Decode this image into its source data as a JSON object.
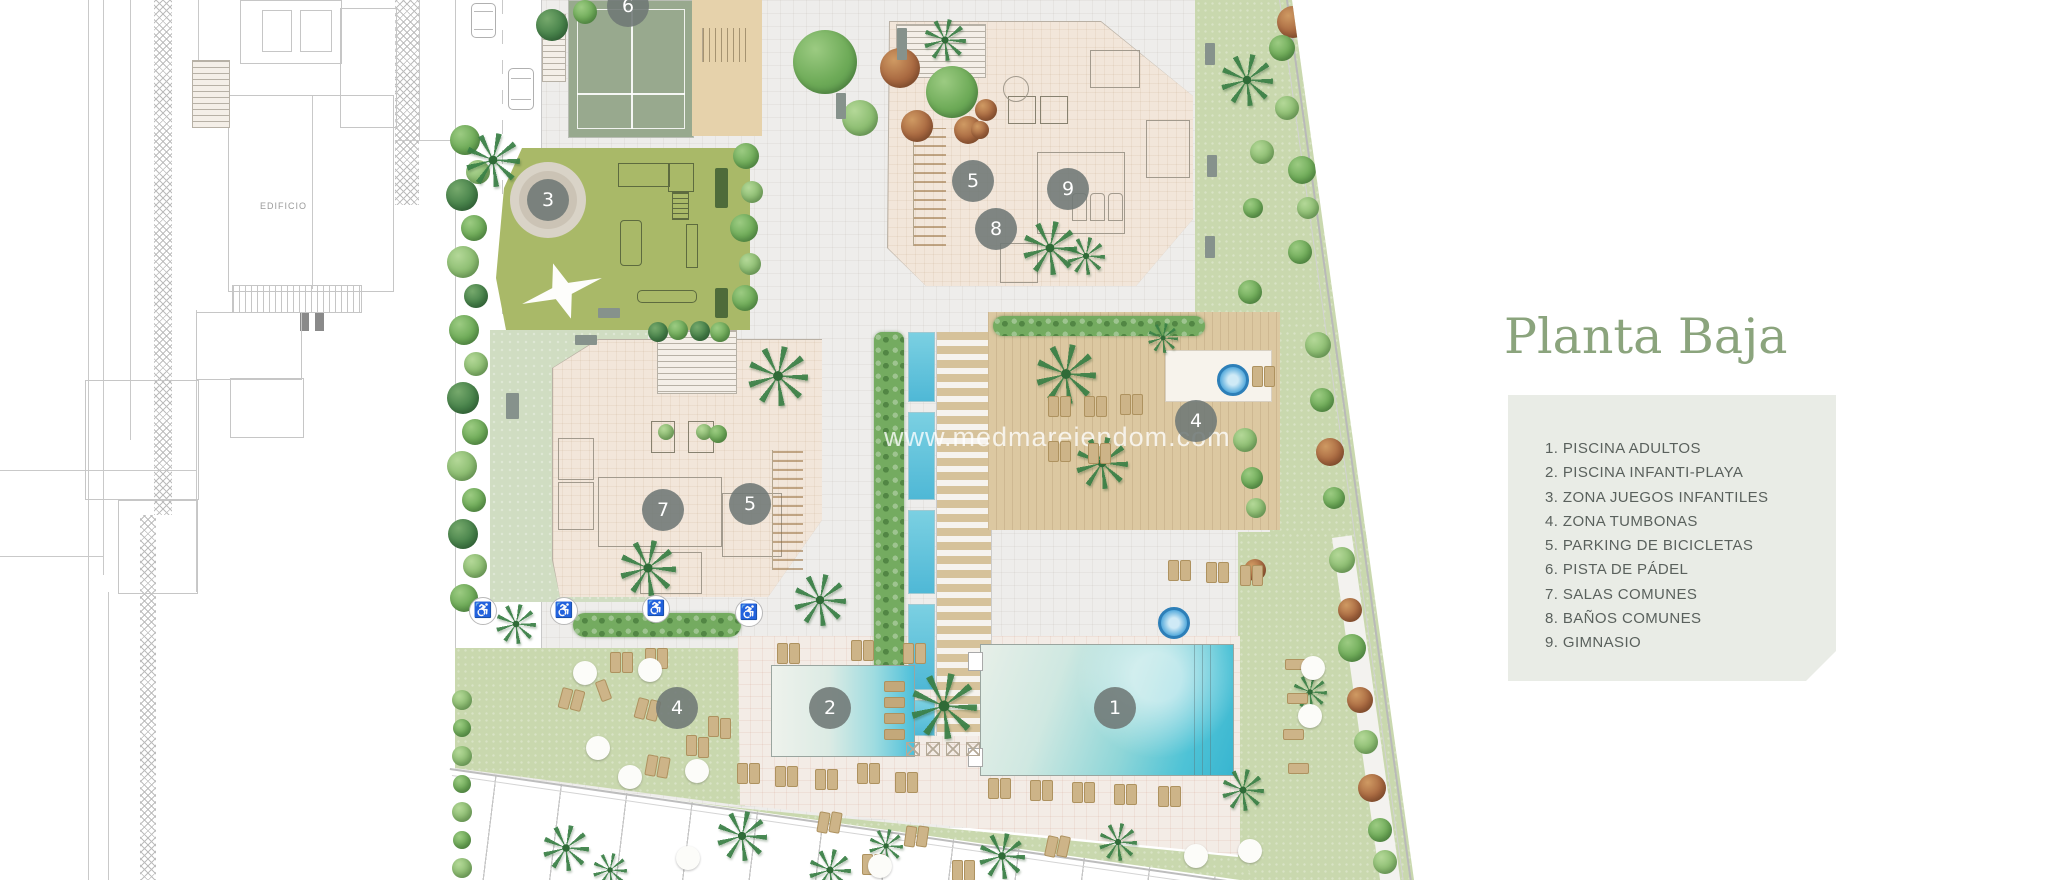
{
  "plan": {
    "watermark": "www.medmareiendom.com",
    "adjacent_building_label": "EDIFICIO",
    "markers": [
      {
        "number": "6",
        "x": 628,
        "y": 6
      },
      {
        "number": "3",
        "x": 548,
        "y": 200
      },
      {
        "number": "5",
        "x": 973,
        "y": 181
      },
      {
        "number": "8",
        "x": 996,
        "y": 229
      },
      {
        "number": "9",
        "x": 1068,
        "y": 189
      },
      {
        "number": "7",
        "x": 663,
        "y": 510
      },
      {
        "number": "5",
        "x": 750,
        "y": 504
      },
      {
        "number": "4",
        "x": 1196,
        "y": 421
      },
      {
        "number": "4",
        "x": 677,
        "y": 708
      },
      {
        "number": "2",
        "x": 830,
        "y": 708
      },
      {
        "number": "1",
        "x": 1115,
        "y": 708
      }
    ]
  },
  "legend": {
    "title": "Planta Baja",
    "items": [
      {
        "number": "1.",
        "label": "PISCINA ADULTOS"
      },
      {
        "number": "2.",
        "label": "PISCINA INFANTI-PLAYA"
      },
      {
        "number": "3.",
        "label": "ZONA JUEGOS INFANTILES"
      },
      {
        "number": "4.",
        "label": "ZONA TUMBONAS"
      },
      {
        "number": "5.",
        "label": "PARKING DE BICICLETAS"
      },
      {
        "number": "6.",
        "label": "PISTA DE PÁDEL"
      },
      {
        "number": "7.",
        "label": "SALAS COMUNES"
      },
      {
        "number": "8.",
        "label": "BAÑOS COMUNES"
      },
      {
        "number": "9.",
        "label": "GIMNASIO"
      }
    ]
  },
  "colors": {
    "accent_green": "#8BA47D",
    "legend_bg": "#E9ECE6",
    "legend_text": "#5A615D",
    "marker_bg": "#6E7775",
    "pool_turquoise": "#45BFD8",
    "lawn": "#C9D8AE",
    "playground": "#A9B968",
    "padel_court": "#98A98E",
    "building": "#F2E6DA",
    "deck_wood": "#DCC8A1"
  }
}
